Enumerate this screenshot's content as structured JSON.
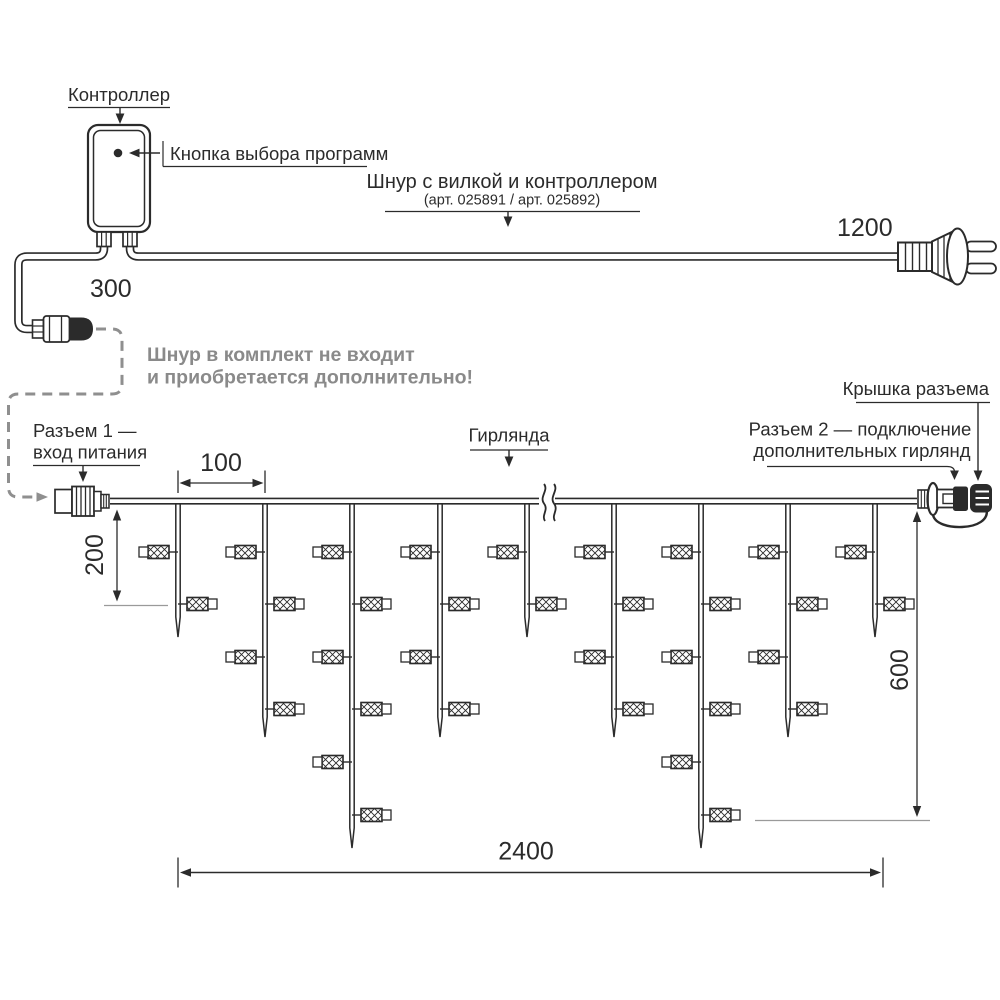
{
  "colors": {
    "ink": "#2b2b2b",
    "gray_dash": "#8f8f8f",
    "gray_text": "#8a8a8a",
    "gray_baseline": "#9a9a9a"
  },
  "labels": {
    "controller": "Контроллер",
    "program_button": "Кнопка выбора программ",
    "cord_title": "Шнур с вилкой и контроллером",
    "cord_art": "(арт. 025891 / арт. 025892)",
    "note_line1": "Шнур в комплект не входит",
    "note_line2": "и приобретается дополнительно!",
    "connector1_line1": "Разъем 1 —",
    "connector1_line2": "вход питания",
    "garland": "Гирлянда",
    "connector_cap": "Крышка разъема",
    "connector2_line1": "Разъем 2 — подключение",
    "connector2_line2": "дополнительных гирлянд"
  },
  "dimensions": {
    "cord_to_connector1": "300",
    "cord_to_plug": "1200",
    "drop_spacing": "100",
    "short_drop_length": "200",
    "max_drop_length": "600",
    "garland_length": "2400"
  },
  "garland": {
    "wire_y": 502,
    "wire_x_start": 110,
    "wire_x_end": 917,
    "lamp_row_ys": [
      552,
      604,
      657,
      709,
      762,
      815
    ],
    "tip_ys": {
      "2": 637,
      "4": 737,
      "6": 848
    },
    "drops": [
      {
        "x": 178,
        "lamps": 2
      },
      {
        "x": 265,
        "lamps": 4
      },
      {
        "x": 352,
        "lamps": 6
      },
      {
        "x": 440,
        "lamps": 4
      },
      {
        "x": 527,
        "lamps": 2
      },
      {
        "x": 614,
        "lamps": 4
      },
      {
        "x": 701,
        "lamps": 6
      },
      {
        "x": 788,
        "lamps": 4
      },
      {
        "x": 875,
        "lamps": 2
      }
    ]
  }
}
